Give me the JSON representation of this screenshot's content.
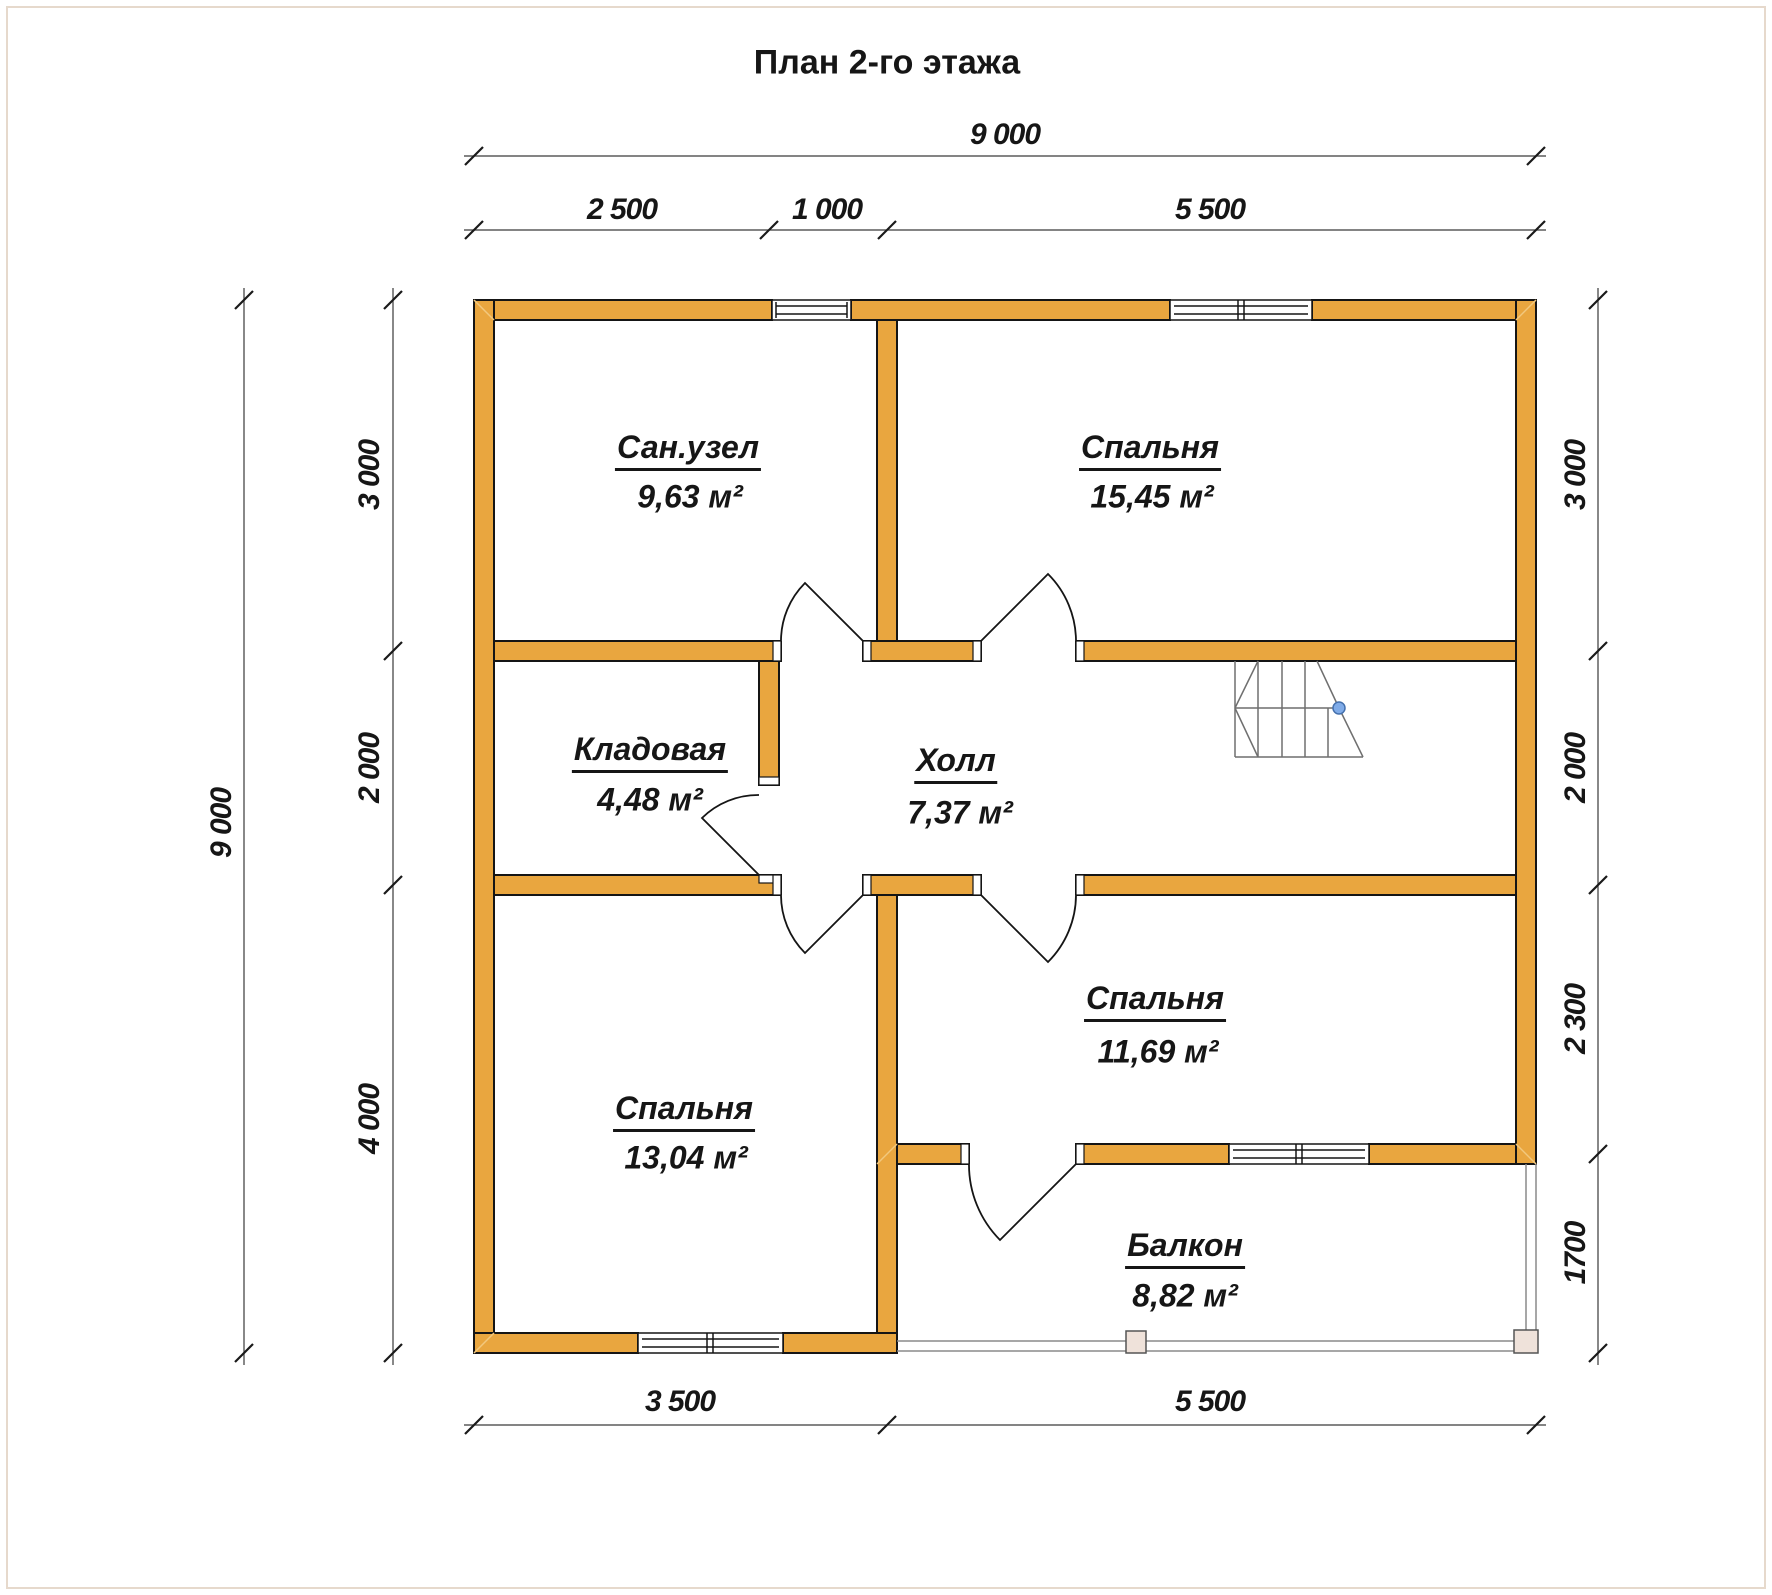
{
  "title": "План 2-го этажа",
  "dimensions": {
    "top": {
      "total": "9 000",
      "segments": [
        "2 500",
        "1 000",
        "5 500"
      ]
    },
    "bottom": {
      "segments": [
        "3 500",
        "5 500"
      ]
    },
    "left": {
      "total": "9 000",
      "segments": [
        "3 000",
        "2 000",
        "4 000"
      ]
    },
    "right": {
      "segments": [
        "3 000",
        "2 000",
        "2 300",
        "1700"
      ]
    }
  },
  "rooms": [
    {
      "name": "Сан.узел",
      "area": "9,63 м²"
    },
    {
      "name": "Спальня",
      "area": "15,45 м²"
    },
    {
      "name": "Кладовая",
      "area": "4,48 м²"
    },
    {
      "name": "Холл",
      "area": "7,37 м²"
    },
    {
      "name": "Спальня",
      "area": "11,69 м²"
    },
    {
      "name": "Спальня",
      "area": "13,04 м²"
    },
    {
      "name": "Балкон",
      "area": "8,82 м²"
    }
  ],
  "colors": {
    "wall": "#E9A63F",
    "outline": "#151515",
    "dim_line": "#3a3a3a",
    "stair_line": "#6f6f6f",
    "stair_dot": "#7FABE8",
    "railing_post": "#EFE2DA",
    "corner_hatch": "#F2C87E",
    "frame": "#e6d9cc"
  }
}
